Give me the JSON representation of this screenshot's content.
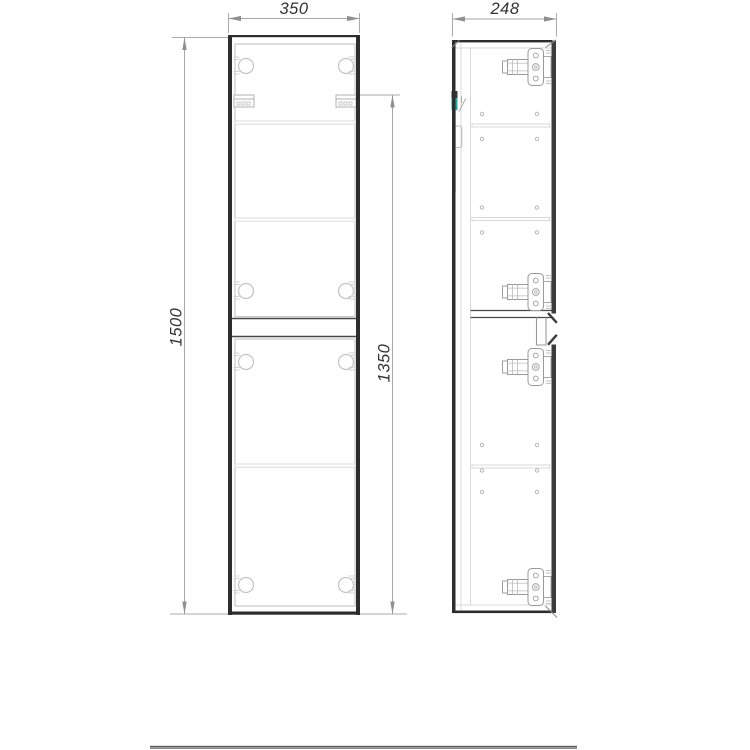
{
  "drawing": {
    "type": "furniture-technical-drawing",
    "subject": "two-door wall-hung tall cabinet, front view and side view",
    "dimensions": {
      "width": "350",
      "depth": "248",
      "height": "1500",
      "mounting_height": "1350"
    },
    "colors": {
      "background": "#ffffff",
      "outline_dark": "#2d2d2d",
      "door_edge_dark": "#3c3c3c",
      "panel_light": "#c9c9c9",
      "dimension_line": "#a5a5a5",
      "dimension_text": "#333333",
      "accent_teal": "#2aa79c",
      "footer_rule": "#8e8e8e"
    }
  }
}
